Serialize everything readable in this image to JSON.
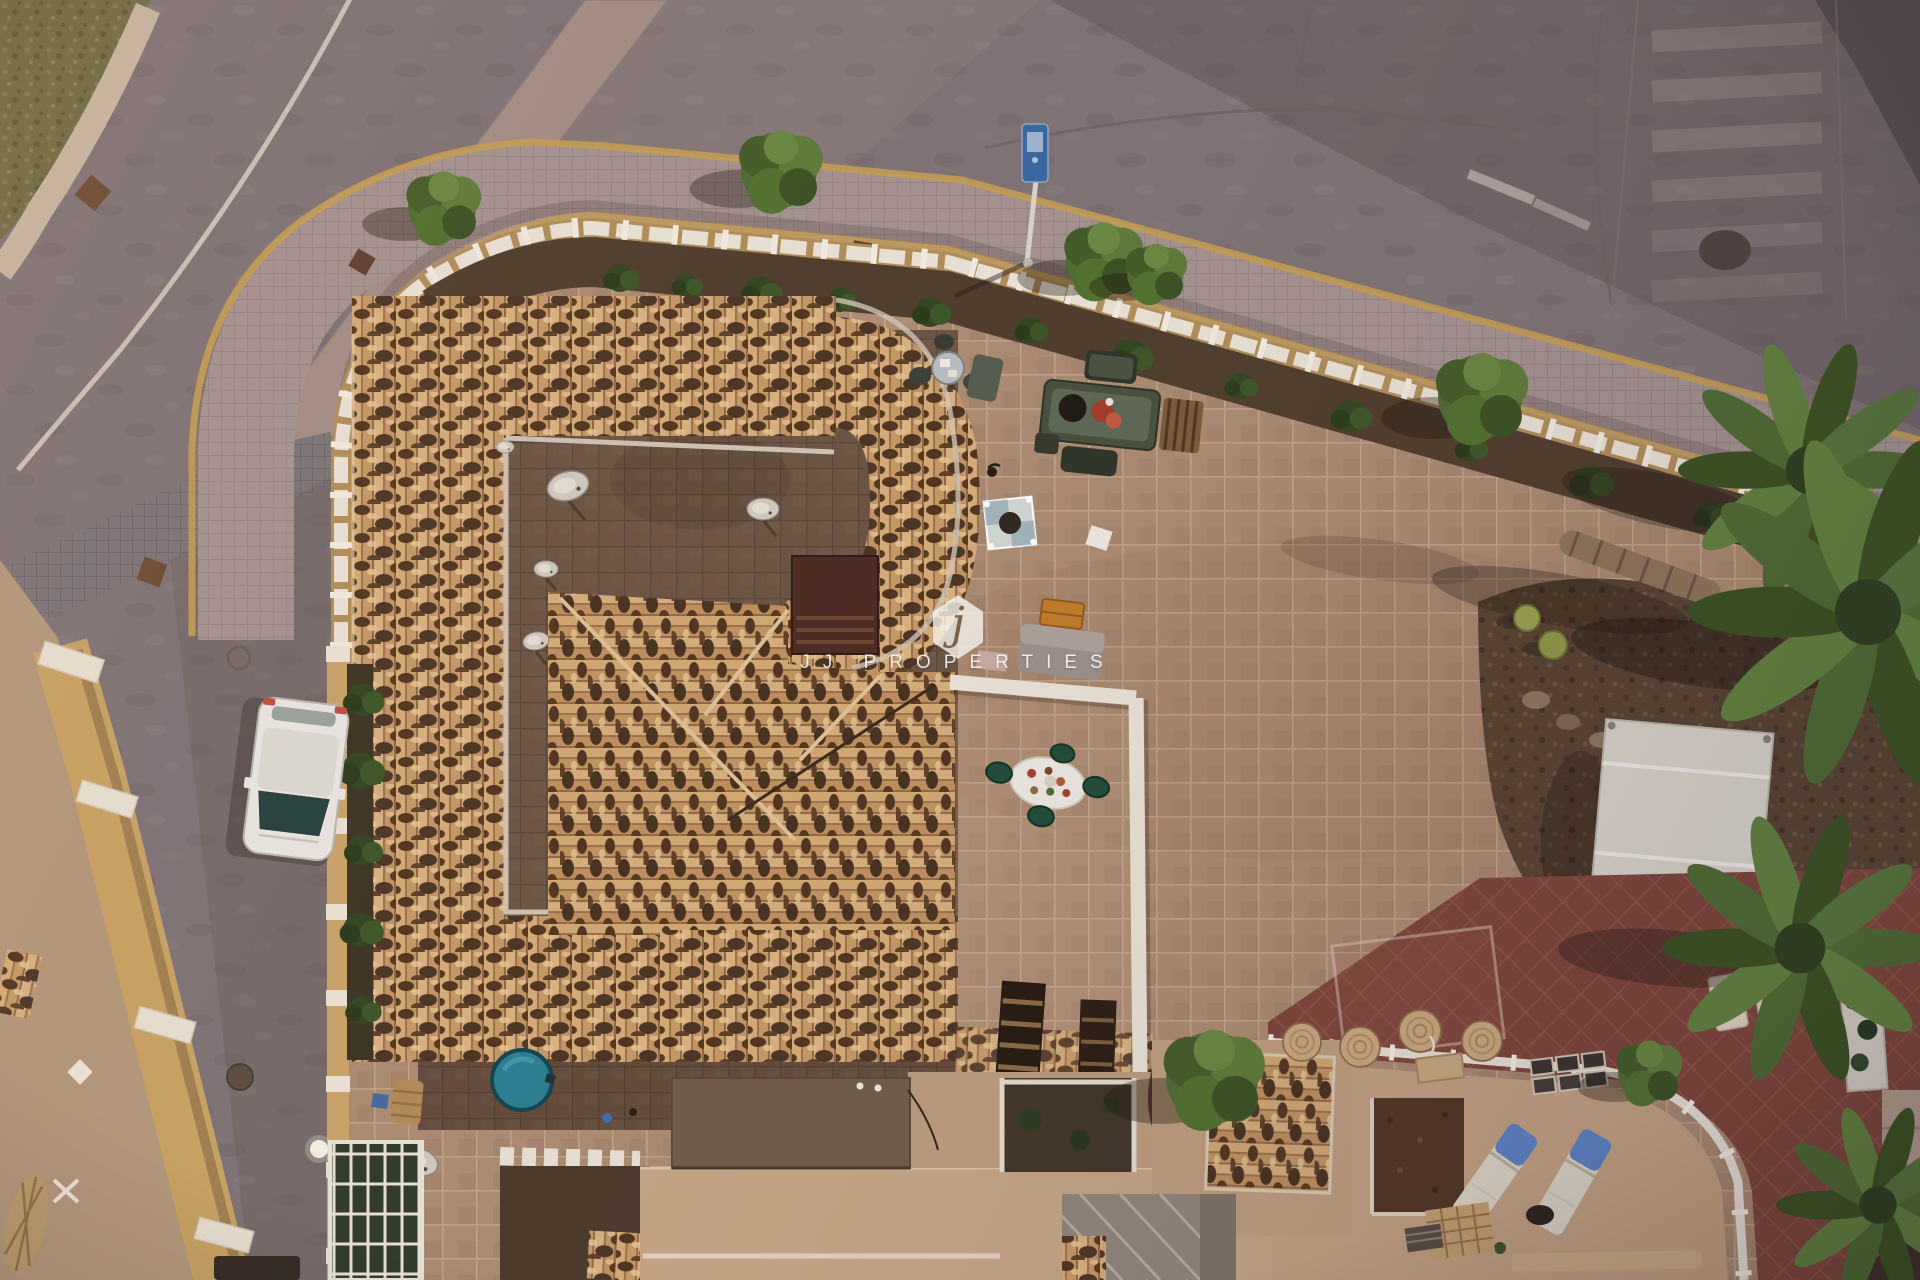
{
  "image": {
    "type": "aerial-drone-photograph",
    "subject": "top-down dusk view of a Spanish villa with terracotta tiled roof, walled tiled terraces, gardens with palm trees, red patio, parked white car and surrounding streets",
    "width_px": 1920,
    "height_px": 1280
  },
  "watermark": {
    "logo_letter": "j",
    "brand": "JJ PROPERTIES"
  },
  "palette": {
    "road": "#7d7275",
    "asphalt_dark": "#574d4f",
    "sidewalk": "#a39190",
    "curb_yellow": "#c29c52",
    "wall_white": "#e9e2d6",
    "wall_yellow": "#c9a368",
    "roof_tile_base": "#c89e6d",
    "roof_tile_dark": "#4a3424",
    "courtyard": "#6b5342",
    "terrace": "#aa8a70",
    "red_patio": "#7c4539",
    "garden_soil": "#57422f",
    "palm_green": "#4d6a31",
    "grass": "#6e6a42",
    "pool_teal": "#2b7e92",
    "car_white": "#e9e7e3",
    "lounger_blue": "#5b82c4",
    "chair_green": "#1e4a38",
    "orange_bench": "#c07b28",
    "gazebo_white": "#dad5cb"
  },
  "scene": {
    "features": [
      "curved street with white lane marking",
      "grass verge in top-left corner",
      "cobbled sidewalk with yellow curbs and young trees",
      "white crenellated boundary wall on yellow base",
      "terracotta tiled villa roof shaped like a G",
      "inner courtyard with satellite dishes",
      "large tan tiled sun terrace with furniture sets",
      "walled dining terrace with oval table and green chairs",
      "rock garden with cacti, fallen palm trunk and palm trees",
      "white gazebo canopy",
      "red tiled patio with curved white railing",
      "sun loungers with blue cushions",
      "round teal plunge-pool cover",
      "parked white hatchback car",
      "street lamp with blue sign",
      "neighbouring walled house with diamond ornament",
      "JJ Properties watermark"
    ]
  }
}
